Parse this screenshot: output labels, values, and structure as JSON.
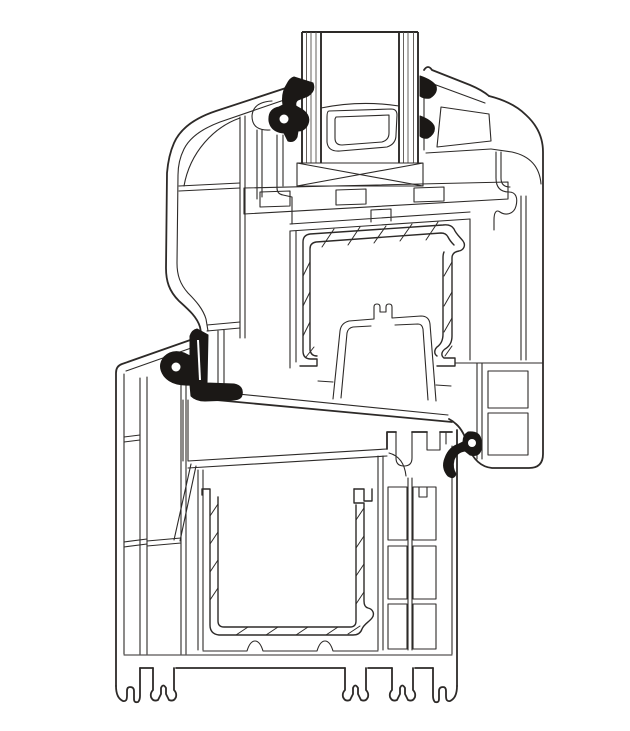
{
  "document": {
    "type": "technical-drawing",
    "title": "Window profile cross-section",
    "description": "Cross-section technical drawing of a uPVC window: frame and sash profiles with multi-chamber structure, insulated glazing unit with spacer bar and setting block, steel reinforcement channels (hatched) and black rubber gaskets and weather seals. Black line art on a white background, no text labels."
  },
  "canvas": {
    "width": 630,
    "height": 731,
    "background": "#ffffff",
    "line_color": "#2d2a28",
    "seal_color": "#1b1816"
  },
  "parts": {
    "glazing_unit": "insulated glazing unit (two panes)",
    "spacer_bar": "glazing spacer bar between panes",
    "setting_block": "glazing setting block (crossed box)",
    "sash_profile": "sash multi-chamber PVC profile",
    "glazing_bead": "interior glazing bead",
    "sash_steel": "sash steel reinforcement (hatched hat channel)",
    "euro_groove": "sash hardware euro-groove",
    "frame_profile": "frame multi-chamber PVC profile with sill feet",
    "frame_steel": "frame steel reinforcement (hatched U channel)",
    "gasket_glass_left": "exterior glazing gasket",
    "gasket_glass_right_top": "interior glazing wedge gasket (upper)",
    "gasket_glass_right_bottom": "interior glazing wedge gasket (lower)",
    "seal_left": "outer weather seal between sash and frame",
    "seal_right": "inner weather seal between sash and frame"
  }
}
